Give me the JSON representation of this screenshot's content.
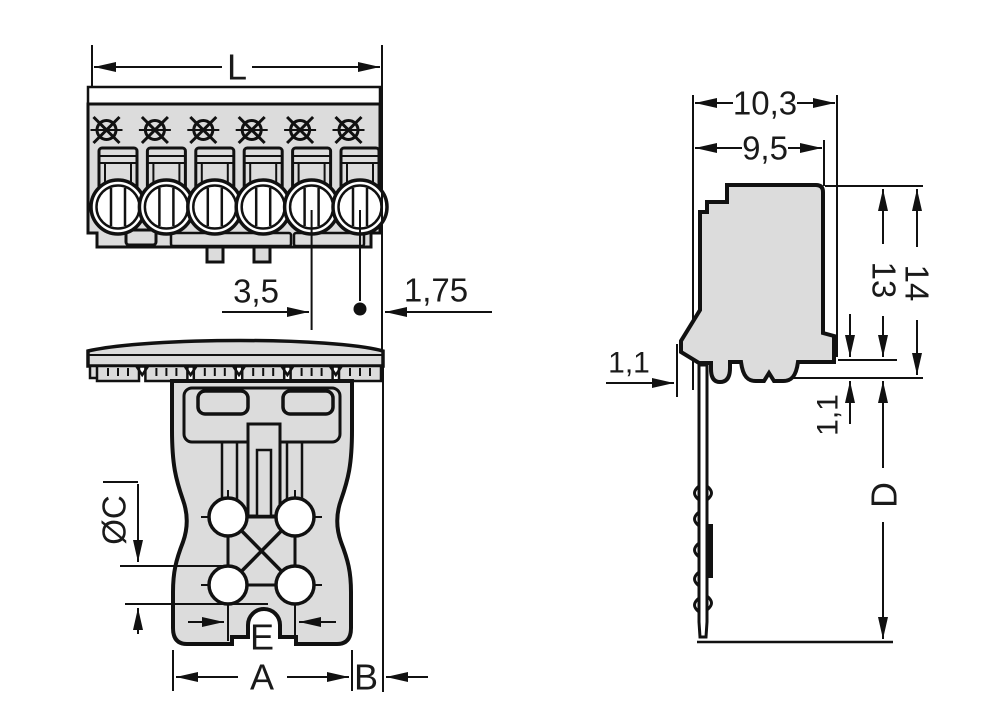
{
  "drawing": {
    "type": "technical-dimension-drawing",
    "component": "6-pole pluggable PCB connector",
    "colors": {
      "background": "#ffffff",
      "body_fill": "#dcdcdc",
      "line": "#111111"
    },
    "views": {
      "front": "front view (6 poles)",
      "underside": "underside view",
      "side": "side view with solder pin"
    },
    "dimensions": {
      "L": "L",
      "pitch": "3,5",
      "half_pitch": "1,75",
      "total_depth": "10,3",
      "housing_depth": "9,5",
      "height_total": "14",
      "height_housing": "13",
      "latch_offset": "1,1",
      "pin_shoulder": "1,1",
      "pin_length": "D",
      "hole_diameter": "ØC",
      "hole_pitch": "E",
      "base_width": "A",
      "side_offset": "B"
    },
    "front_view": {
      "pole_count": 6
    }
  }
}
